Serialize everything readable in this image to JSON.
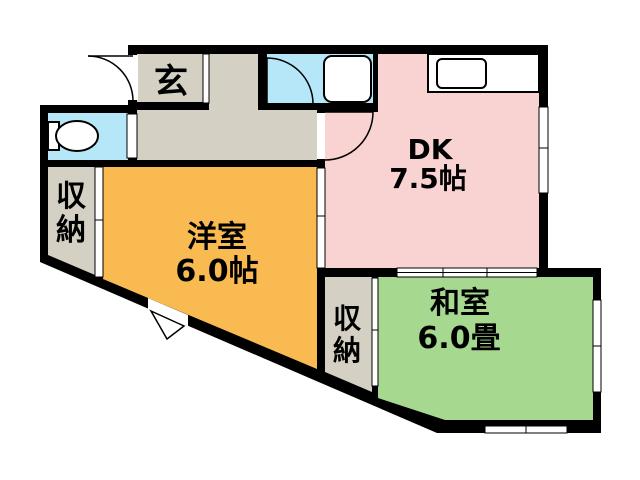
{
  "plan": {
    "rooms": {
      "genkan": {
        "label": "玄"
      },
      "dk": {
        "label": "DK",
        "size": "7.5帖"
      },
      "western_room": {
        "label": "洋室",
        "size": "6.0帖"
      },
      "japanese_room": {
        "label": "和室",
        "size": "6.0畳"
      },
      "closet_left": {
        "label": "収納",
        "chars": [
          "収",
          "納"
        ]
      },
      "closet_right": {
        "label": "収納",
        "chars": [
          "収",
          "納"
        ]
      }
    },
    "colors": {
      "wall": "#000000",
      "dk": "#f9d2d2",
      "western_room": "#f8ba51",
      "japanese_room": "#a6d98f",
      "hall": "#d4d0c3",
      "water": "#b6e7f8",
      "white": "#ffffff"
    }
  }
}
